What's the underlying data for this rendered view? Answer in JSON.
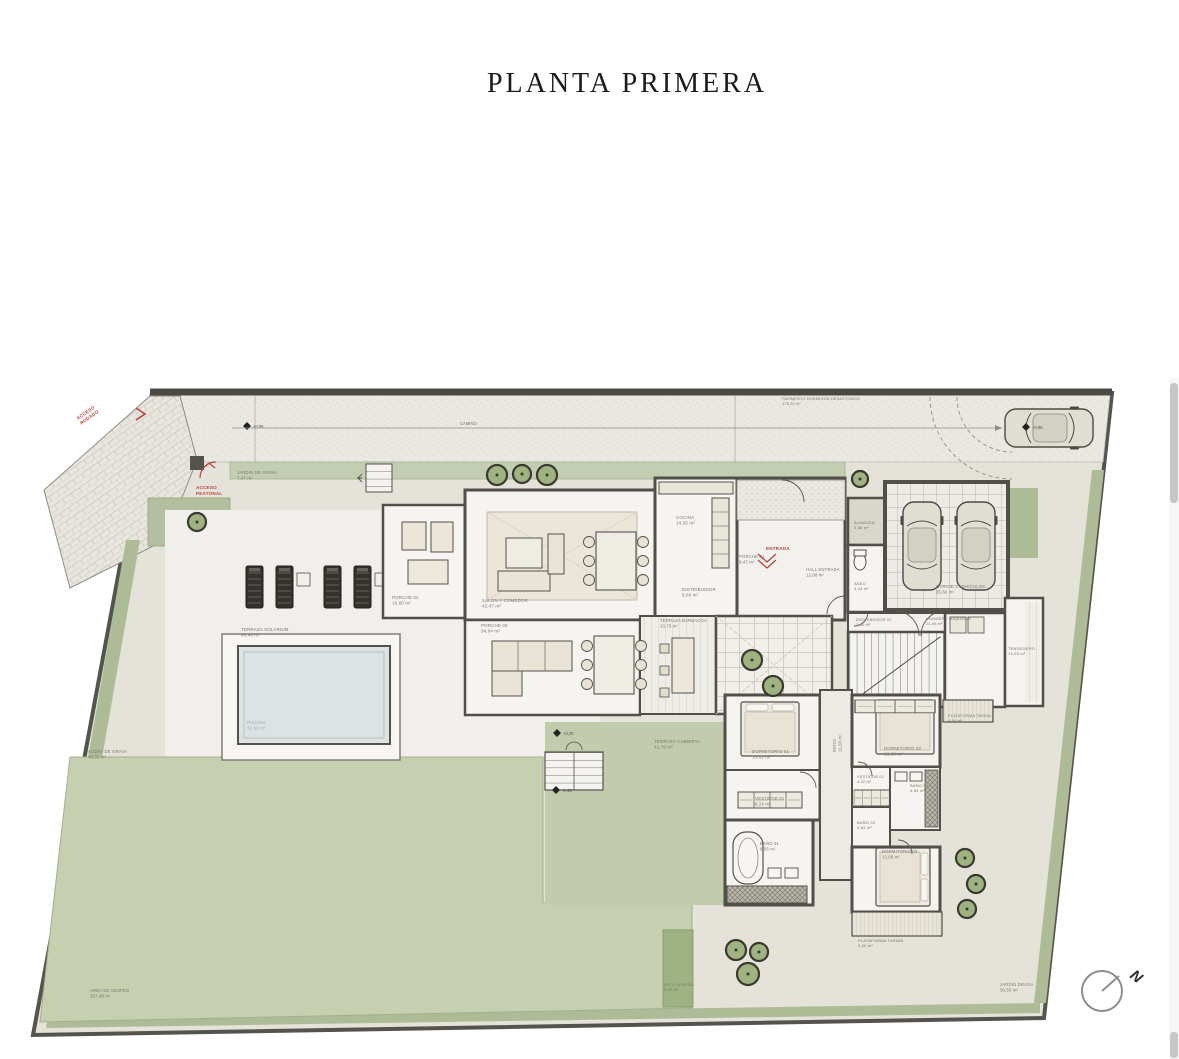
{
  "page": {
    "title": "PLANTA PRIMERA"
  },
  "compass": {
    "letter": "N"
  },
  "colors": {
    "background": "#ffffff",
    "plot_base": "#e4e2d9",
    "driveway": "#e9e8e3",
    "lawn": "#c6cfb0",
    "hedge": "#aebb97",
    "hedge_strip": "#c3cdb2",
    "terrace_green": "#c2cbab",
    "room_floor": "#f5f4f0",
    "pool_water": "#dde2e2",
    "wall": "#514f49",
    "furniture": "#ebe6d8",
    "label_text": "#76746c",
    "red_accent": "#b8443a",
    "scrollbar_thumb": "#c6c6c6"
  },
  "plan": {
    "dimension": {
      "label": "CAMINO",
      "x1": 232,
      "y1": 428,
      "x2": 1002,
      "y2": 428,
      "lx": 460,
      "ly": 425
    },
    "labels": [
      {
        "name": "jardin-grava-norte",
        "lines": [
          "JARDIN DE GRAVA",
          "7,47 m²"
        ],
        "x": 237,
        "y": 474,
        "size": 4.2
      },
      {
        "name": "pavimento-hormigon",
        "lines": [
          "PAVIMENTO HORMIGON DESACTIVADO",
          "176,20 m²"
        ],
        "x": 782,
        "y": 400,
        "size": 3.8
      },
      {
        "name": "porche-02",
        "lines": [
          "PORCHE 02",
          "16,80 m²"
        ],
        "x": 392,
        "y": 599,
        "size": 4.4
      },
      {
        "name": "salon-comedor",
        "lines": [
          "SALON Y COMEDOR",
          "42,47 m²"
        ],
        "x": 482,
        "y": 602,
        "size": 4.4
      },
      {
        "name": "porche-03",
        "lines": [
          "PORCHE 03",
          "34,04 m²"
        ],
        "x": 481,
        "y": 627,
        "size": 4.4
      },
      {
        "name": "cocina",
        "lines": [
          "COCINA",
          "14,05 m²"
        ],
        "x": 676,
        "y": 519,
        "size": 4.4
      },
      {
        "name": "porche-01",
        "lines": [
          "PORCHE 01",
          "9,47 m²"
        ],
        "x": 739,
        "y": 558,
        "size": 4.2
      },
      {
        "name": "hall-entrada",
        "lines": [
          "HALL ENTRADA",
          "12,88 m²"
        ],
        "x": 806,
        "y": 571,
        "size": 4.2
      },
      {
        "name": "distribuidor",
        "lines": [
          "DISTRIBUIDOR",
          "9,06 m²"
        ],
        "x": 682,
        "y": 591,
        "size": 4.4
      },
      {
        "name": "aseo",
        "lines": [
          "ASEO",
          "3,44 m²"
        ],
        "x": 854,
        "y": 585,
        "size": 4
      },
      {
        "name": "almacen",
        "lines": [
          "ALMACEN",
          "3,86 m²"
        ],
        "x": 854,
        "y": 524,
        "size": 4
      },
      {
        "name": "garaje",
        "lines": [
          "GARAJE 2 VEHICULOS",
          "35,60 m²"
        ],
        "x": 936,
        "y": 588,
        "size": 4.2
      },
      {
        "name": "terraza-barbacoa",
        "lines": [
          "TERRAZA BARBACOA",
          "10,75 m²"
        ],
        "x": 660,
        "y": 622,
        "size": 4.2
      },
      {
        "name": "distribuidor-01",
        "lines": [
          "DISTRIBUIDOR 01",
          "3,35 m²"
        ],
        "x": 856,
        "y": 621,
        "size": 3.8
      },
      {
        "name": "lavadero-maquinas",
        "lines": [
          "LAVADERO MAQUINAS",
          "11,40 m²"
        ],
        "x": 926,
        "y": 620,
        "size": 3.8
      },
      {
        "name": "tendedero",
        "lines": [
          "TENDEDERO",
          "13,05 m²"
        ],
        "x": 1008,
        "y": 650,
        "size": 4
      },
      {
        "name": "terraza-solarium",
        "lines": [
          "TERRAZA SOLARIUM",
          "48,46 m²"
        ],
        "x": 241,
        "y": 631,
        "size": 4.4
      },
      {
        "name": "piscina",
        "lines": [
          "PISCINA",
          "32,00 m²"
        ],
        "x": 247,
        "y": 724,
        "size": 4.4,
        "color": "#a3abab"
      },
      {
        "name": "terraza-cubierta",
        "lines": [
          "TERRAZA CUBIERTA",
          "41,76 m²"
        ],
        "x": 654,
        "y": 743,
        "size": 4.4
      },
      {
        "name": "dormitorio-01",
        "lines": [
          "DORMITORIO 01",
          "13,01 m²"
        ],
        "x": 752,
        "y": 753,
        "size": 4.4
      },
      {
        "name": "dormitorio-02",
        "lines": [
          "DORMITORIO 02",
          "13,88 m²"
        ],
        "x": 884,
        "y": 750,
        "size": 4.4
      },
      {
        "name": "vestidor-01",
        "lines": [
          "VESTIDOR 01",
          "8,14 m²"
        ],
        "x": 755,
        "y": 800,
        "size": 4.2
      },
      {
        "name": "vestidor-02",
        "lines": [
          "VESTIDOR 02",
          "4,42 m²"
        ],
        "x": 857,
        "y": 778,
        "size": 3.8
      },
      {
        "name": "bano-02",
        "lines": [
          "BAÑO 02",
          "4,89 m²"
        ],
        "x": 910,
        "y": 787,
        "size": 4
      },
      {
        "name": "bano-01",
        "lines": [
          "BAÑO 01",
          "9,56 m²"
        ],
        "x": 760,
        "y": 845,
        "size": 4.2
      },
      {
        "name": "bano-03",
        "lines": [
          "BAÑO 03",
          "4,64 m²"
        ],
        "x": 857,
        "y": 824,
        "size": 4
      },
      {
        "name": "dormitorio-03",
        "lines": [
          "DORMITORIO 03",
          "13,08 m²"
        ],
        "x": 882,
        "y": 853,
        "size": 4.2
      },
      {
        "name": "patio",
        "lines": [
          "PATIO",
          "11,00 m²"
        ],
        "x": 836,
        "y": 752,
        "size": 4.2,
        "rot": -90
      },
      {
        "name": "plataforma-tarima-1",
        "lines": [
          "PLATAFORMA TARIMA",
          "4,84 m²"
        ],
        "x": 948,
        "y": 717,
        "size": 3.8
      },
      {
        "name": "plataforma-tarima-2",
        "lines": [
          "PLATAFORMA TARIMA",
          "9,20 m²"
        ],
        "x": 858,
        "y": 942,
        "size": 4
      },
      {
        "name": "acera-grava",
        "lines": [
          "ACERA DE GRAVA",
          "40,32 m²"
        ],
        "x": 88,
        "y": 753,
        "size": 4.2
      },
      {
        "name": "area-cesped",
        "lines": [
          "AREA DE CESPED",
          "357,88 m²"
        ],
        "x": 90,
        "y": 992,
        "size": 4.2
      },
      {
        "name": "seto-vegetal",
        "lines": [
          "SETO VEGETAL",
          "8,40 m²"
        ],
        "x": 664,
        "y": 986,
        "size": 3.8
      },
      {
        "name": "jardin-draga",
        "lines": [
          "JARDIN DRAGA",
          "36,50 m²"
        ],
        "x": 1000,
        "y": 986,
        "size": 4.2
      }
    ],
    "red_annotations": [
      {
        "name": "acceso-rodado",
        "lines": [
          "ACCESO",
          "RODADO"
        ],
        "x": 78,
        "y": 420,
        "rot": -35
      },
      {
        "name": "acceso-peatonal",
        "lines": [
          "ACCESO",
          "PEATONAL"
        ],
        "x": 196,
        "y": 489,
        "rot": 0
      },
      {
        "name": "entrada",
        "lines": [
          "ENTRADA"
        ],
        "x": 766,
        "y": 550,
        "rot": 0
      }
    ],
    "level_markers": [
      {
        "value": "+0,95",
        "x": 247,
        "y": 426
      },
      {
        "value": "+0,95",
        "x": 1026,
        "y": 427
      },
      {
        "value": "+0,00",
        "x": 557,
        "y": 733
      },
      {
        "value": "-0,45",
        "x": 556,
        "y": 790
      }
    ],
    "trees": [
      {
        "x": 497,
        "y": 475,
        "r": 10
      },
      {
        "x": 522,
        "y": 474,
        "r": 9
      },
      {
        "x": 547,
        "y": 475,
        "r": 10
      },
      {
        "x": 197,
        "y": 522,
        "r": 9
      },
      {
        "x": 860,
        "y": 479,
        "r": 8
      },
      {
        "x": 752,
        "y": 660,
        "r": 10
      },
      {
        "x": 773,
        "y": 686,
        "r": 10
      },
      {
        "x": 965,
        "y": 858,
        "r": 9
      },
      {
        "x": 976,
        "y": 884,
        "r": 9
      },
      {
        "x": 967,
        "y": 909,
        "r": 9
      },
      {
        "x": 736,
        "y": 950,
        "r": 10
      },
      {
        "x": 759,
        "y": 952,
        "r": 9
      },
      {
        "x": 748,
        "y": 974,
        "r": 11
      }
    ]
  }
}
